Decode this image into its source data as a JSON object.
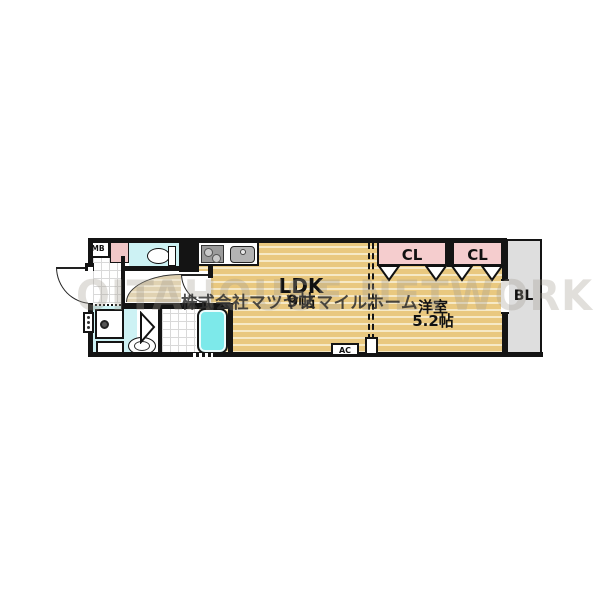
{
  "plan": {
    "rooms": {
      "ldk": {
        "name": "LDK",
        "size": "9帖"
      },
      "bedroom": {
        "name": "洋室",
        "size": "5.2帖"
      },
      "closet1": {
        "label": "CL"
      },
      "closet2": {
        "label": "CL"
      },
      "balcony": {
        "label": "BL"
      },
      "meter_box": {
        "label": "MB"
      },
      "air_conditioner": {
        "label": "AC"
      }
    },
    "watermarks": {
      "company": "株式会社マツヤスマイルホーム",
      "background": "OITAHOUSE NETWORK"
    },
    "colors": {
      "flooring": "#e9c87f",
      "flooring_stripe": "#f6e9c6",
      "closet_pink": "#f5cdce",
      "water_cyan": "#cdf2f4",
      "bathtub_cyan": "#7de9ea",
      "balcony_gray": "#dedede",
      "wall": "#141414"
    },
    "icons": [
      "toilet-icon",
      "stove-icon",
      "sink-icon",
      "bathtub-icon",
      "washbasin-icon",
      "washing-machine-pan-icon",
      "water-heater-icon",
      "folding-door-icon",
      "door-swing-icon"
    ]
  }
}
